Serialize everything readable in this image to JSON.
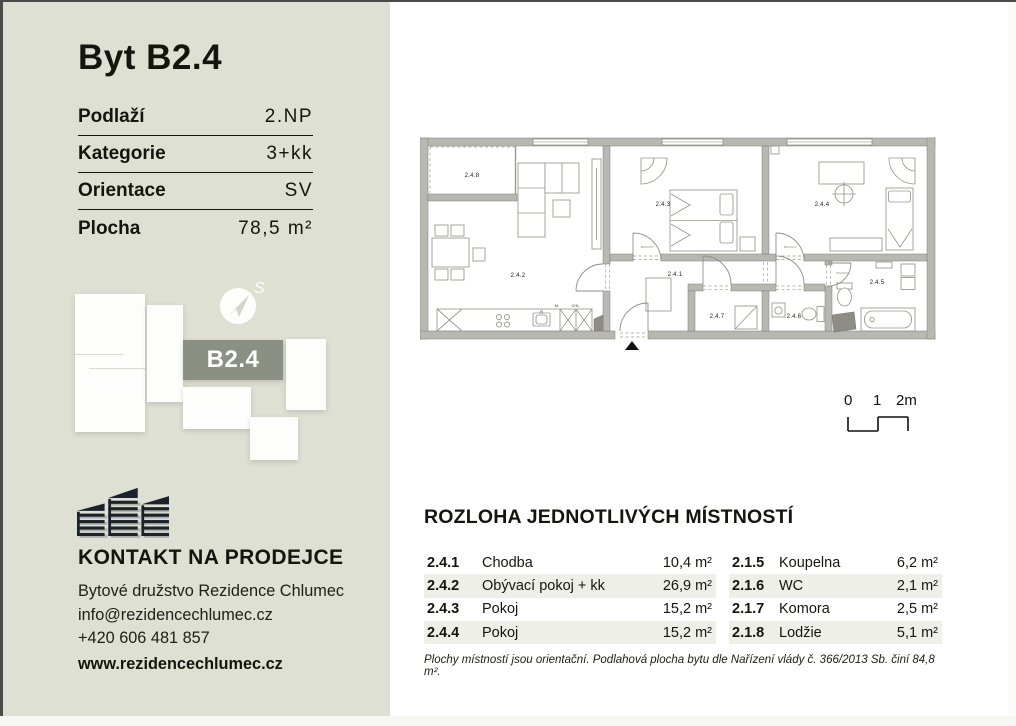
{
  "colors": {
    "sidebar_bg": "#dee0d4",
    "badge_bg": "#8b9084",
    "row_shade": "#efefea",
    "wall_gray": "#b8b8b2"
  },
  "sidebar": {
    "title": "Byt B2.4",
    "specs": [
      {
        "label": "Podlaží",
        "value": "2.NP"
      },
      {
        "label": "Kategorie",
        "value": "3+kk"
      },
      {
        "label": "Orientace",
        "value": "SV"
      },
      {
        "label": "Plocha",
        "value": "78,5 m²"
      }
    ],
    "unit_badge": "B2.4",
    "compass_letter": "S",
    "contact": {
      "heading": "KONTAKT NA PRODEJCE",
      "company": "Bytové družstvo Rezidence Chlumec",
      "email": "info@rezidencechlumec.cz",
      "phone": "+420 606 481 857",
      "website": "www.rezidencechlumec.cz"
    }
  },
  "plan": {
    "rooms": {
      "r241": "2.4.1",
      "r242": "2.4.2",
      "r243": "2.4.3",
      "r244": "2.4.4",
      "r245": "2.4.5",
      "r246": "2.4.6",
      "r247": "2.4.7",
      "r248": "2.4.8"
    },
    "appliances": {
      "m": "M.",
      "chl": "CHL."
    },
    "door_sizes": {
      "a": "800/1970",
      "b": "700/1970"
    },
    "scale": {
      "t0": "0",
      "t1": "1",
      "t2": "2m"
    }
  },
  "rooms_section": {
    "heading": "ROZLOHA JEDNOTLIVÝCH MÍSTNOSTÍ",
    "left": [
      {
        "code": "2.4.1",
        "name": "Chodba",
        "area": "10,4 m²"
      },
      {
        "code": "2.4.2",
        "name": "Obývací pokoj + kk",
        "area": "26,9 m²"
      },
      {
        "code": "2.4.3",
        "name": "Pokoj",
        "area": "15,2 m²"
      },
      {
        "code": "2.4.4",
        "name": "Pokoj",
        "area": "15,2 m²"
      }
    ],
    "right": [
      {
        "code": "2.1.5",
        "name": "Koupelna",
        "area": "6,2 m²"
      },
      {
        "code": "2.1.6",
        "name": "WC",
        "area": "2,1 m²"
      },
      {
        "code": "2.1.7",
        "name": "Komora",
        "area": "2,5 m²"
      },
      {
        "code": "2.1.8",
        "name": "Lodžie",
        "area": "5,1 m²"
      }
    ],
    "footnote": "Plochy místností jsou orientační. Podlahová plocha bytu dle Nařízení vlády č. 366/2013 Sb. činí 84,8 m²."
  }
}
